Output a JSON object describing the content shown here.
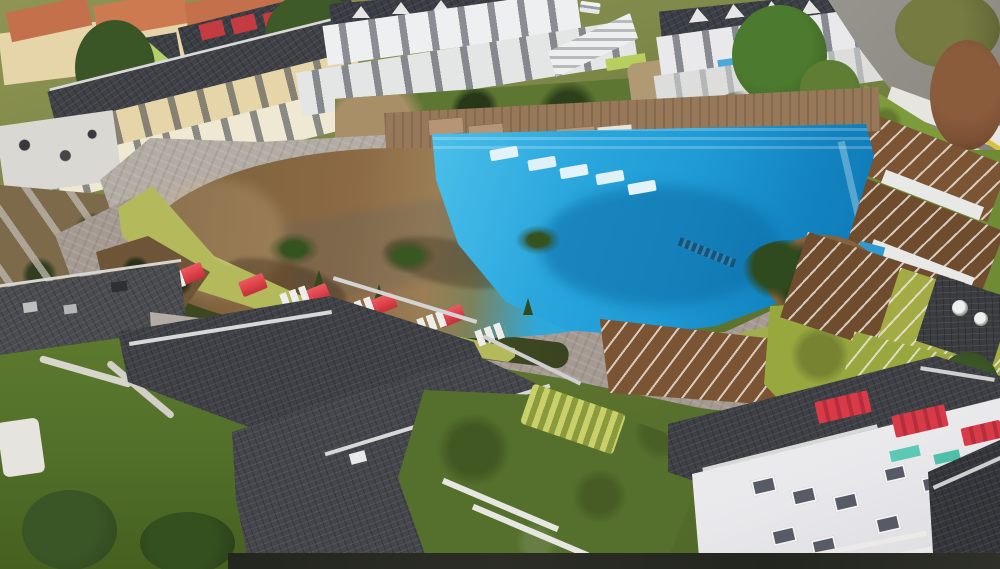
{
  "image": {
    "kind": "aerial drone photograph",
    "subject": "Holiday resort complex with large free-form swimming pool, villas and apartment blocks",
    "no_visible_text": true
  },
  "scene": {
    "pool": {
      "main_section": "free-form pool, upper-right half filled with bright blue water and stepped shallow ledges",
      "lagoon_section": "lower-left lagoon half with murky brown water and beach-style entry",
      "in_pool_loungers": 5,
      "handrail": "dark rail grate on right infinity edge"
    },
    "pool_deck": {
      "surface": "grey stone pavers with chartreuse grass edging",
      "red_umbrellas": 5,
      "white_lounger_groups": 6,
      "young_palms": 4,
      "sun_mats_on_wood_deck": 5
    },
    "buildings": {
      "behind_top_left": "yellow houses with terracotta roofs among dark trees",
      "top_left": "cream three-storey villas with dark roofs, lime gables and balconies",
      "top_center": "white terraced apartment block with external staircase and courtyard garden",
      "top_right": "white villas with gabled dark roofs and dormers, blue balcony awnings",
      "right_edge": "brown shingle pergola roofs stepping downhill beside access road",
      "bottom_right": "large white villa with red window awnings, teal trim and roof satellite dishes",
      "foreground": "dark shingle hip roofs with white ridge caps, AC units and satellite dishes"
    },
    "landscape": [
      "green lawns",
      "clipped hedges",
      "white garden paths and railings",
      "access road with yellow guardrail top right",
      "autumn rust trees",
      "white car parked near top center"
    ]
  },
  "colors": {
    "pool-blue": "#2aa6dd",
    "pool-blue-light": "#4cc0ea",
    "pool-blue-deep": "#0e77b2",
    "lagoon-brown": "#8b6a45",
    "lagoon-tan": "#9b7e55",
    "deck-grey": "#a59a92",
    "deck-light": "#b3aca4",
    "grass-edge": "#b4b95c",
    "lawn-green": "#5d7a2e",
    "lawn-dark": "#46601f",
    "lawn-bright": "#98a83f",
    "roof-dark": "#3f4146",
    "roof-charcoal": "#34363b",
    "roof-brown": "#7b5434",
    "roof-orange": "#c4714b",
    "wall-white": "#e9e9ec",
    "wall-cream": "#e6d5a8",
    "umbrella-red": "#e0454c",
    "awning-red": "#d83a48",
    "accent-teal": "#5cc9b4",
    "accent-blue-awning": "#4aa9d8",
    "tree-green": "#3f5c2a",
    "tree-dark": "#2e4520",
    "tree-olive": "#6a6f3a",
    "tree-rust": "#7a4f33",
    "road-grey": "#8f8c86",
    "path-white": "#d8d5cc",
    "dirt-brown": "#6e5537",
    "guardrail-yellow": "#d8c23c"
  }
}
